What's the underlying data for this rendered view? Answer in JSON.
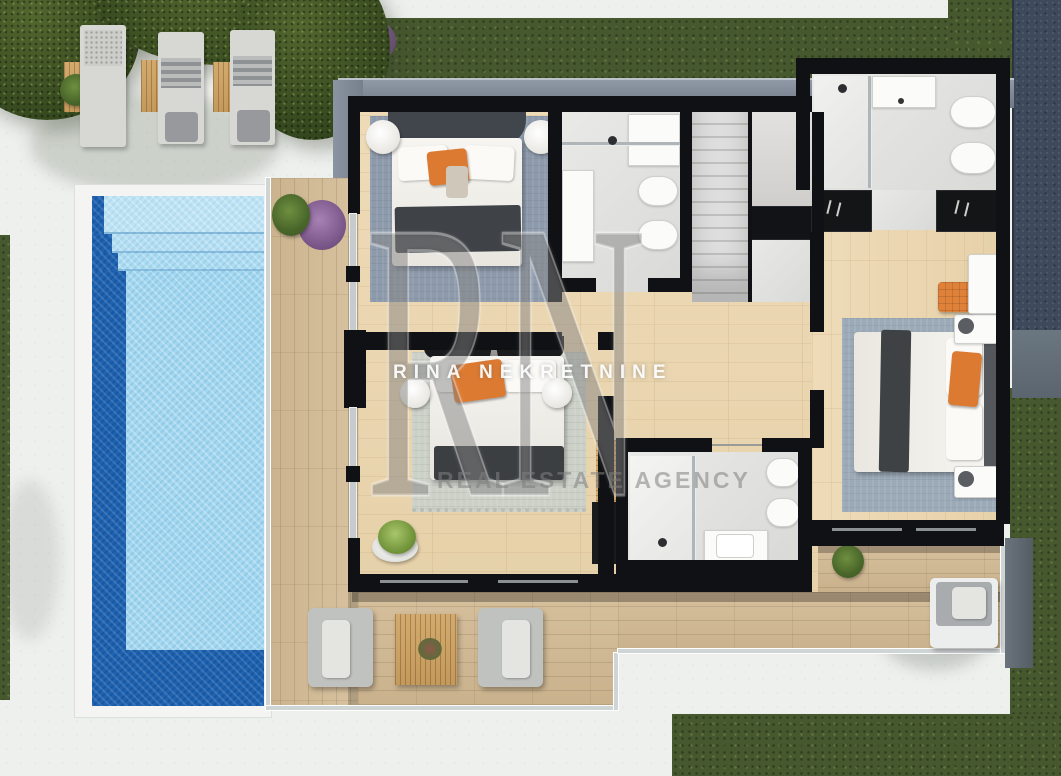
{
  "watermark": {
    "monogram": "RN",
    "agency_name": "RINA NEKRETNINE",
    "agency_tagline": "REAL ESTATE AGENCY"
  },
  "palette": {
    "pavement": "#eef0ee",
    "wall_black": "#101114",
    "wood_floor": "#e9d7b4",
    "terrace_deck": "#d5bf9c",
    "bathroom_tile": "#e3e3e1",
    "pool_water_light": "#a3d8f0",
    "pool_water_dark": "#1e63b2",
    "grass_green": "#46582e",
    "roof_navy": "#3e4a5c",
    "roof_edge_gray": "#828c99",
    "rug_blue_gray": "#8d9aab",
    "rug_sage": "#ccd1c8",
    "rug_slate": "#9caab8",
    "accent_orange": "#dd7a31",
    "furniture_gray": "#c0c2bf"
  },
  "scene": {
    "type": "3d-floor-plan-render",
    "objects": [
      "swimming-pool",
      "pool-steps",
      "sun-loungers",
      "side-tables",
      "terrace-deck",
      "glass-railing",
      "armchairs",
      "coffee-table",
      "lounge-chair",
      "potted-plants",
      "bedroom-beds",
      "night-lamps",
      "rugs",
      "wardrobes",
      "staircase",
      "bathroom-shower",
      "bathroom-vanity",
      "toilet",
      "bidet",
      "lawn",
      "roof-band"
    ]
  }
}
